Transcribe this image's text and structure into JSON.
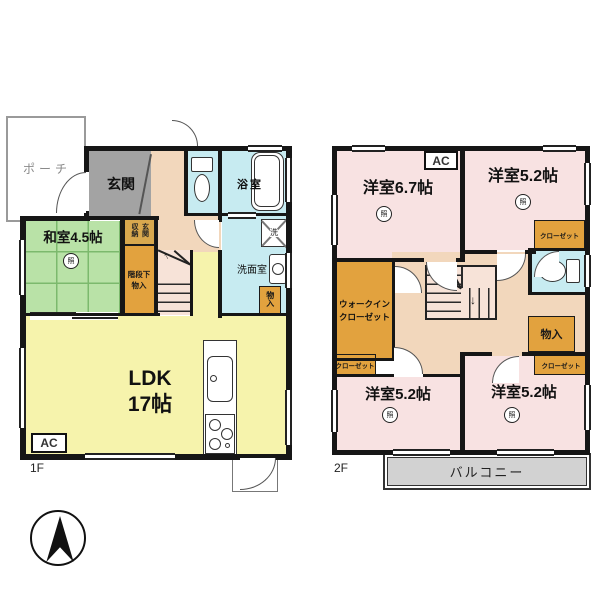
{
  "floor1": {
    "floor_label": "1F",
    "porch": "ポーチ",
    "genkan": "玄関",
    "washitsu": "和室4.5帖",
    "genkan_storage": "玄関収納",
    "stair_storage_line1": "階段下",
    "stair_storage_line2": "物入",
    "bath": "浴室",
    "washroom": "洗面室",
    "storage": "物入",
    "washer_mark": "洗",
    "ldk_line1": "LDK",
    "ldk_line2": "17帖",
    "ac_label": "AC"
  },
  "floor2": {
    "floor_label": "2F",
    "bedroom_67": "洋室6.7帖",
    "bedroom_52_top_right": "洋室5.2帖",
    "bedroom_52_bottom_left": "洋室5.2帖",
    "bedroom_52_bottom_right": "洋室5.2帖",
    "wic_line1": "ウォークイン",
    "wic_line2": "クローゼット",
    "closet_top_right": "クローゼット",
    "closet_bottom_left": "クローゼット",
    "closet_bottom_right": "クローゼット",
    "storage": "物入",
    "balcony": "バルコニー",
    "ac_label": "AC"
  },
  "symbols": {
    "ceiling_light": "照",
    "stairs_up_arrow": "↑",
    "stairs_down_arrow": "↓"
  },
  "colors": {
    "tatami_green": "#b9e2a7",
    "ldk_yellow": "#f6f3ac",
    "hall_peach": "#f2d7bc",
    "stairs_pink": "#f7e3d8",
    "water_blue": "#c7ebf1",
    "bedroom_pink": "#f8e2e2",
    "closet_orange": "#e2a23e",
    "genkan_gray": "#a3a3a3",
    "balcony_gray": "#d2d2d2",
    "wall_black": "#161616"
  }
}
